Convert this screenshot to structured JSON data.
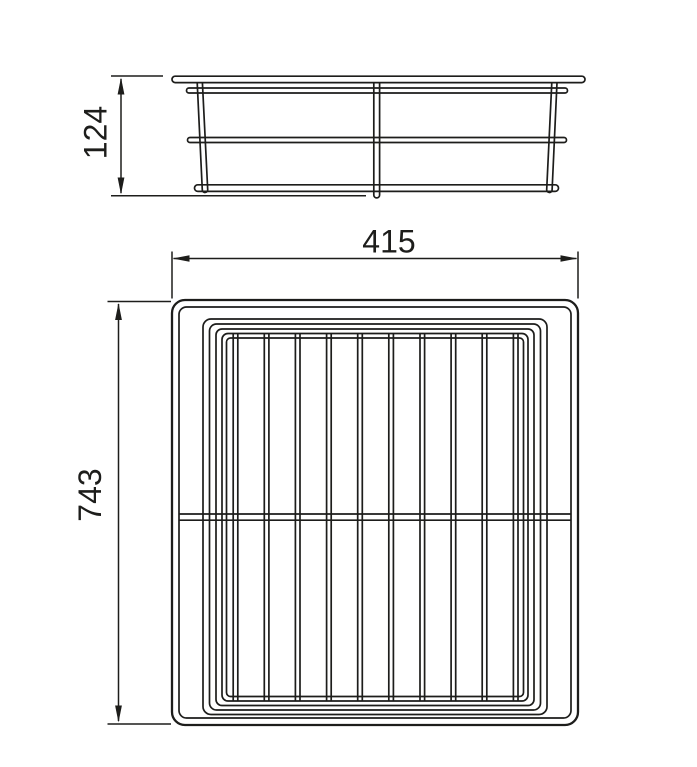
{
  "page": {
    "background": "#ffffff"
  },
  "drawing": {
    "line_color": "#1d1d1b",
    "text_color": "#1d1d1b",
    "views": {
      "side_view": {
        "height_dimension": {
          "label": "124"
        }
      },
      "plan_view": {
        "width_dimension": {
          "label": "415"
        },
        "depth_dimension": {
          "label": "743"
        }
      }
    }
  }
}
